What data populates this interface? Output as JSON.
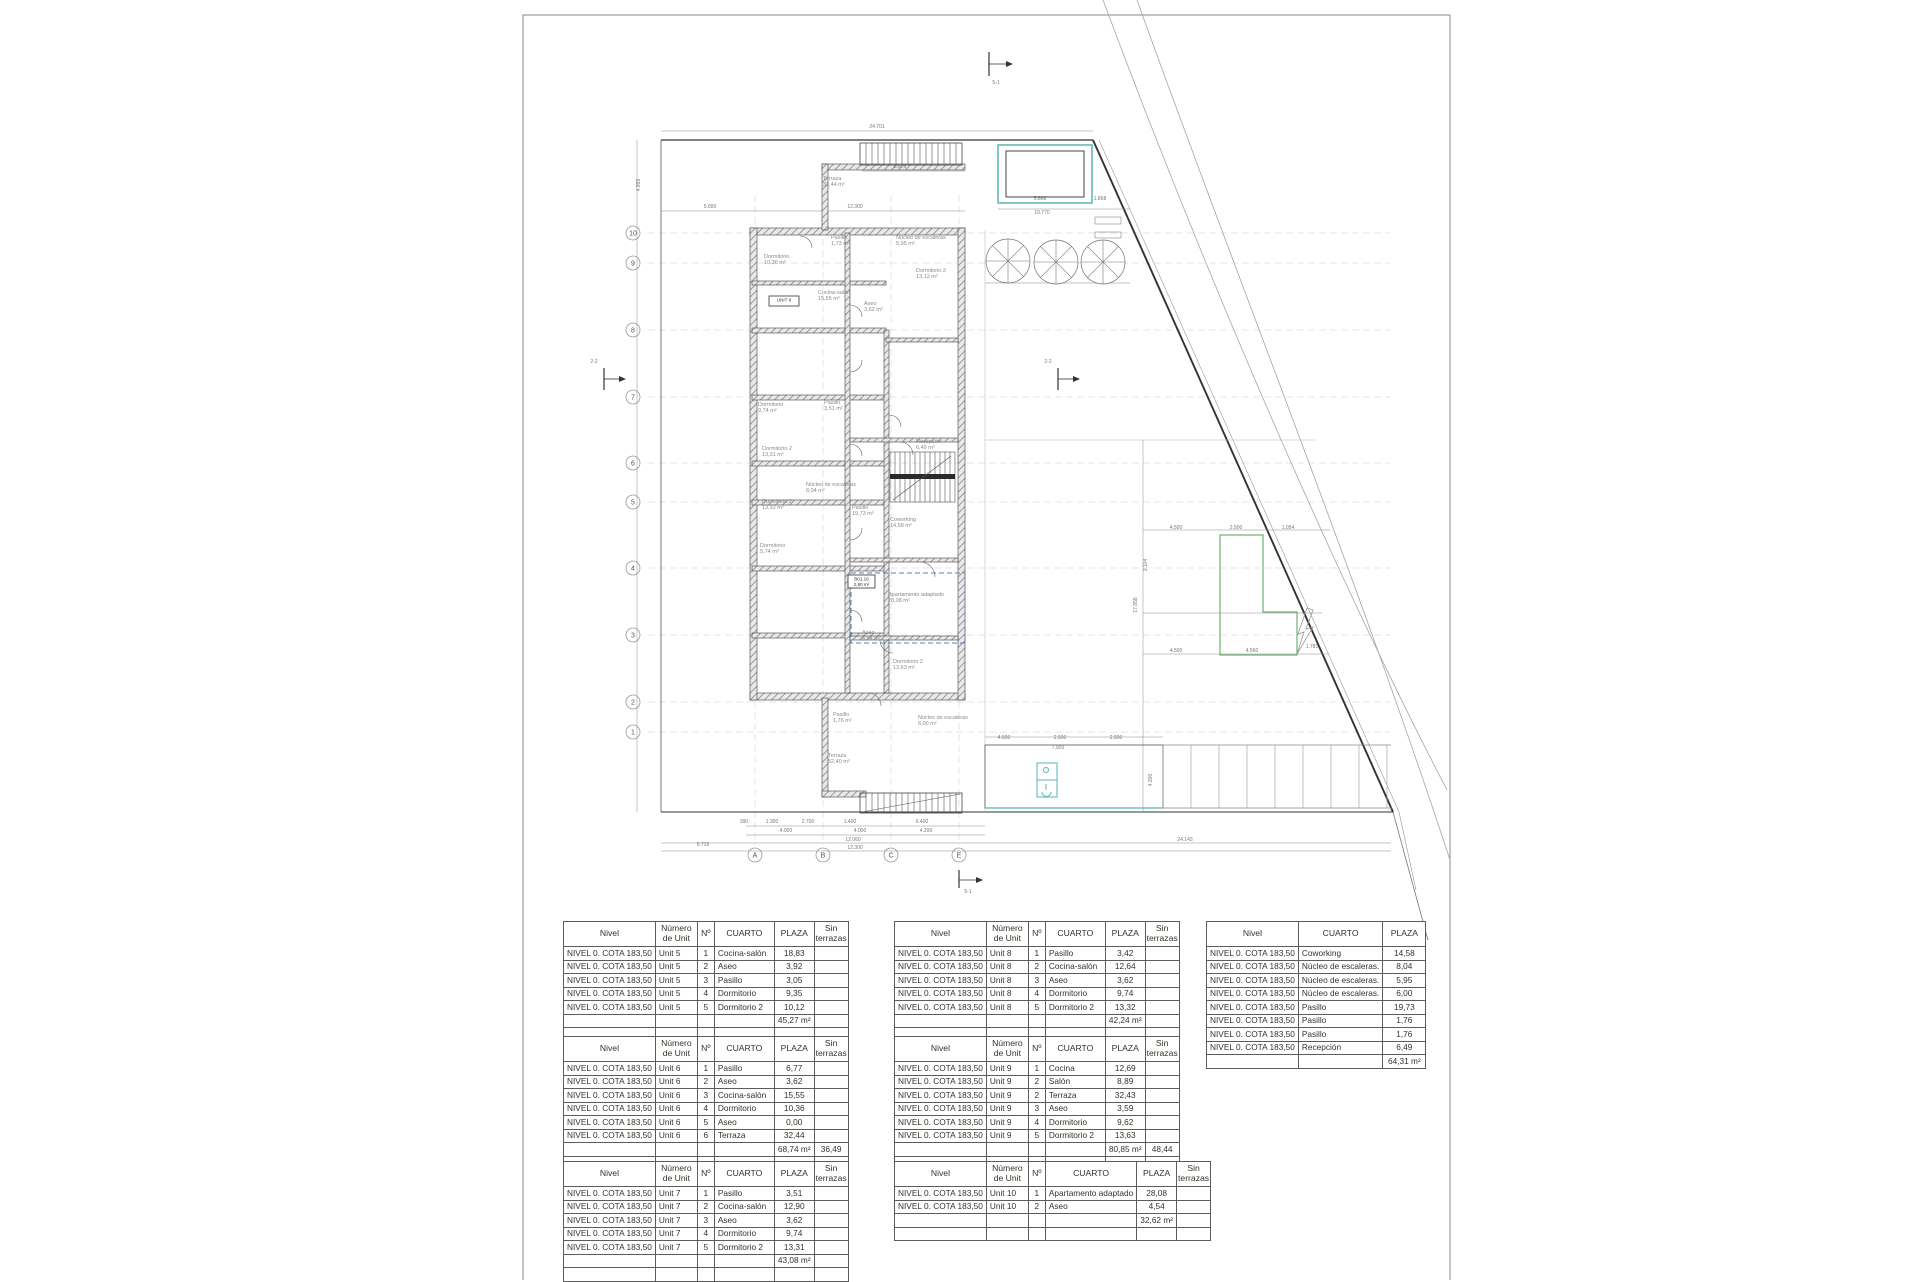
{
  "plan": {
    "colors": {
      "teal": "#5ab5b0",
      "green": "#52a352",
      "blue": "#5a7fc4",
      "line": "#3c3c3c",
      "light": "#9a9a9a"
    },
    "grid_rows": [
      {
        "label": "10",
        "y": 233
      },
      {
        "label": "9",
        "y": 263
      },
      {
        "label": "8",
        "y": 330
      },
      {
        "label": "7",
        "y": 397
      },
      {
        "label": "6",
        "y": 463
      },
      {
        "label": "5",
        "y": 502
      },
      {
        "label": "4",
        "y": 568
      },
      {
        "label": "3",
        "y": 635
      },
      {
        "label": "2",
        "y": 702
      },
      {
        "label": "1",
        "y": 732
      }
    ],
    "grid_cols": [
      {
        "label": "A",
        "x": 755
      },
      {
        "label": "B",
        "x": 823
      },
      {
        "label": "C",
        "x": 891
      },
      {
        "label": "E",
        "x": 959
      }
    ],
    "room_labels": [
      {
        "t": "Terraza|32,44 m²",
        "x": 823,
        "y": 180
      },
      {
        "t": "Pasillo|1,73 m²",
        "x": 831,
        "y": 239
      },
      {
        "t": "Núcleo de escaleras|5,95 m²",
        "x": 896,
        "y": 239
      },
      {
        "t": "Dormitorio|10,36 m²",
        "x": 764,
        "y": 258
      },
      {
        "t": "Dormitorio 2|13,12 m²",
        "x": 916,
        "y": 272
      },
      {
        "t": "Cocina-salón|15,55 m²",
        "x": 818,
        "y": 294
      },
      {
        "t": "Aseo|3,62 m²",
        "x": 864,
        "y": 305
      },
      {
        "t": "Dormitorio|9,74 m²",
        "x": 758,
        "y": 406
      },
      {
        "t": "Pasillo|3,51 m²",
        "x": 824,
        "y": 404
      },
      {
        "t": "Recepción|6,49 m²",
        "x": 916,
        "y": 443
      },
      {
        "t": "Dormitorio 2|13,31 m²",
        "x": 762,
        "y": 450
      },
      {
        "t": "Núcleo de escaleras|8,04 m²",
        "x": 806,
        "y": 486
      },
      {
        "t": "Pasillo|19,73 m²",
        "x": 852,
        "y": 509
      },
      {
        "t": "Dormitorio 2|13,32 m²",
        "x": 762,
        "y": 503
      },
      {
        "t": "Coworking|14,58 m²",
        "x": 890,
        "y": 521
      },
      {
        "t": "Dormitorio|5,74 m²",
        "x": 760,
        "y": 547
      },
      {
        "t": "Apartamento adaptado|28,08 m²",
        "x": 888,
        "y": 596
      },
      {
        "t": "Aseo|4,54 m²",
        "x": 862,
        "y": 634
      },
      {
        "t": "Dormitorio 2|13,63 m²",
        "x": 893,
        "y": 663
      },
      {
        "t": "Pasillo|1,76 m²",
        "x": 833,
        "y": 716
      },
      {
        "t": "Núcleo de escaleras|6,00 m²",
        "x": 918,
        "y": 719
      },
      {
        "t": "Terraza|52,40 m²",
        "x": 828,
        "y": 757
      }
    ],
    "boxed_labels": [
      {
        "t": "UNIT 6",
        "x": 769,
        "y": 296,
        "w": 30,
        "h": 10
      },
      {
        "t": "B01.16|2,80 m²",
        "x": 848,
        "y": 575,
        "w": 27,
        "h": 13
      }
    ],
    "dim_labels": [
      {
        "t": "24.701",
        "x": 877,
        "y": 128
      },
      {
        "t": "8.675",
        "x": 900,
        "y": 168
      },
      {
        "t": "5.000",
        "x": 710,
        "y": 208
      },
      {
        "t": "12.300",
        "x": 855,
        "y": 208
      },
      {
        "t": "5.868",
        "x": 1040,
        "y": 200
      },
      {
        "t": "1.868",
        "x": 1100,
        "y": 200
      },
      {
        "t": "10.770",
        "x": 1042,
        "y": 214
      },
      {
        "t": "390",
        "x": 744,
        "y": 823
      },
      {
        "t": "1.300",
        "x": 772,
        "y": 823
      },
      {
        "t": "2.700",
        "x": 808,
        "y": 823
      },
      {
        "t": "1.400",
        "x": 850,
        "y": 823
      },
      {
        "t": "6.400",
        "x": 922,
        "y": 823
      },
      {
        "t": "4.000",
        "x": 786,
        "y": 832
      },
      {
        "t": "4.000",
        "x": 860,
        "y": 832
      },
      {
        "t": "4.200",
        "x": 926,
        "y": 832
      },
      {
        "t": "12.060",
        "x": 853,
        "y": 841
      },
      {
        "t": "12.300",
        "x": 855,
        "y": 849
      },
      {
        "t": "5.715",
        "x": 703,
        "y": 846
      },
      {
        "t": "24.143",
        "x": 1185,
        "y": 841
      },
      {
        "t": "4.500",
        "x": 1176,
        "y": 529
      },
      {
        "t": "2.500",
        "x": 1236,
        "y": 529
      },
      {
        "t": "1.054",
        "x": 1288,
        "y": 529
      },
      {
        "t": "4.500",
        "x": 1176,
        "y": 652
      },
      {
        "t": "4.560",
        "x": 1252,
        "y": 652
      },
      {
        "t": "1.781",
        "x": 1312,
        "y": 648
      },
      {
        "t": "4.500",
        "x": 1004,
        "y": 739
      },
      {
        "t": "2.500",
        "x": 1060,
        "y": 739
      },
      {
        "t": "2.500",
        "x": 1116,
        "y": 739
      },
      {
        "t": "7.920",
        "x": 1058,
        "y": 749
      },
      {
        "t": "4.999",
        "x": 640,
        "y": 185,
        "rot": -90
      },
      {
        "t": "3.104",
        "x": 1147,
        "y": 565,
        "rot": -90
      },
      {
        "t": "17.858",
        "x": 1137,
        "y": 605,
        "rot": -90
      },
      {
        "t": "4.300",
        "x": 1152,
        "y": 780,
        "rot": -90
      },
      {
        "t": "5-1",
        "x": 996,
        "y": 84
      },
      {
        "t": "5-1",
        "x": 968,
        "y": 893
      },
      {
        "t": "2-2",
        "x": 594,
        "y": 363
      },
      {
        "t": "2-2",
        "x": 1048,
        "y": 363
      }
    ]
  },
  "tables": {
    "unit5": {
      "headers": [
        "Nivel",
        "Número de Unit",
        "Nº",
        "CUARTO",
        "PLAZA",
        "Sin terrazas"
      ],
      "rows": [
        [
          "NIVEL 0. COTA 183,50",
          "Unit 5",
          "1",
          "Cocina-salón",
          "18,83",
          ""
        ],
        [
          "NIVEL 0. COTA 183,50",
          "Unit 5",
          "2",
          "Aseo",
          "3,92",
          ""
        ],
        [
          "NIVEL 0. COTA 183,50",
          "Unit 5",
          "3",
          "Pasillo",
          "3,05",
          ""
        ],
        [
          "NIVEL 0. COTA 183,50",
          "Unit 5",
          "4",
          "Dormitorio",
          "9,35",
          ""
        ],
        [
          "NIVEL 0. COTA 183,50",
          "Unit 5",
          "5",
          "Dormitorio 2",
          "10,12",
          ""
        ],
        [
          "",
          "",
          "",
          "",
          "45,27 m²",
          ""
        ],
        [
          "",
          "",
          "",
          "",
          "",
          ""
        ]
      ]
    },
    "unit6": {
      "headers": [
        "Nivel",
        "Número de Unit",
        "Nº",
        "CUARTO",
        "PLAZA",
        "Sin terrazas"
      ],
      "rows": [
        [
          "NIVEL 0. COTA 183,50",
          "Unit 6",
          "1",
          "Pasillo",
          "6,77",
          ""
        ],
        [
          "NIVEL 0. COTA 183,50",
          "Unit 6",
          "2",
          "Aseo",
          "3,62",
          ""
        ],
        [
          "NIVEL 0. COTA 183,50",
          "Unit 6",
          "3",
          "Cocina-salón",
          "15,55",
          ""
        ],
        [
          "NIVEL 0. COTA 183,50",
          "Unit 6",
          "4",
          "Dormitorio",
          "10,36",
          ""
        ],
        [
          "NIVEL 0. COTA 183,50",
          "Unit 6",
          "5",
          "Aseo",
          "0,00",
          ""
        ],
        [
          "NIVEL 0. COTA 183,50",
          "Unit 6",
          "6",
          "Terraza",
          "32,44",
          ""
        ],
        [
          "",
          "",
          "",
          "",
          "68,74 m²",
          "36,49"
        ],
        [
          "",
          "",
          "",
          "",
          "",
          ""
        ]
      ]
    },
    "unit7": {
      "headers": [
        "Nivel",
        "Número de Unit",
        "Nº",
        "CUARTO",
        "PLAZA",
        "Sin terrazas"
      ],
      "rows": [
        [
          "NIVEL 0. COTA 183,50",
          "Unit 7",
          "1",
          "Pasillo",
          "3,51",
          ""
        ],
        [
          "NIVEL 0. COTA 183,50",
          "Unit 7",
          "2",
          "Cocina-salón",
          "12,90",
          ""
        ],
        [
          "NIVEL 0. COTA 183,50",
          "Unit 7",
          "3",
          "Aseo",
          "3,62",
          ""
        ],
        [
          "NIVEL 0. COTA 183,50",
          "Unit 7",
          "4",
          "Dormitorio",
          "9,74",
          ""
        ],
        [
          "NIVEL 0. COTA 183,50",
          "Unit 7",
          "5",
          "Dormitorio 2",
          "13,31",
          ""
        ],
        [
          "",
          "",
          "",
          "",
          "43,08 m²",
          ""
        ],
        [
          "",
          "",
          "",
          "",
          "",
          ""
        ]
      ]
    },
    "unit8": {
      "headers": [
        "Nivel",
        "Número de Unit",
        "Nº",
        "CUARTO",
        "PLAZA",
        "Sin terrazas"
      ],
      "rows": [
        [
          "NIVEL 0. COTA 183,50",
          "Unit 8",
          "1",
          "Pasillo",
          "3,42",
          ""
        ],
        [
          "NIVEL 0. COTA 183,50",
          "Unit 8",
          "2",
          "Cocina-salón",
          "12,64",
          ""
        ],
        [
          "NIVEL 0. COTA 183,50",
          "Unit 8",
          "3",
          "Aseo",
          "3,62",
          ""
        ],
        [
          "NIVEL 0. COTA 183,50",
          "Unit 8",
          "4",
          "Dormitorio",
          "9,74",
          ""
        ],
        [
          "NIVEL 0. COTA 183,50",
          "Unit 8",
          "5",
          "Dormitorio 2",
          "13,32",
          ""
        ],
        [
          "",
          "",
          "",
          "",
          "42,24 m²",
          ""
        ],
        [
          "",
          "",
          "",
          "",
          "",
          ""
        ]
      ]
    },
    "unit9": {
      "headers": [
        "Nivel",
        "Número de Unit",
        "Nº",
        "CUARTO",
        "PLAZA",
        "Sin terrazas"
      ],
      "rows": [
        [
          "NIVEL 0. COTA 183,50",
          "Unit 9",
          "1",
          "Cocina",
          "12,69",
          ""
        ],
        [
          "NIVEL 0. COTA 183,50",
          "Unit 9",
          "2",
          "Salón",
          "8,89",
          ""
        ],
        [
          "NIVEL 0. COTA 183,50",
          "Unit 9",
          "2",
          "Terraza",
          "32,43",
          ""
        ],
        [
          "NIVEL 0. COTA 183,50",
          "Unit 9",
          "3",
          "Aseo",
          "3,59",
          ""
        ],
        [
          "NIVEL 0. COTA 183,50",
          "Unit 9",
          "4",
          "Dormitorio",
          "9,62",
          ""
        ],
        [
          "NIVEL 0. COTA 183,50",
          "Unit 9",
          "5",
          "Dormitorio 2",
          "13,63",
          ""
        ],
        [
          "",
          "",
          "",
          "",
          "80,85 m²",
          "48,44"
        ],
        [
          "",
          "",
          "",
          "",
          "",
          ""
        ]
      ]
    },
    "unit10": {
      "headers": [
        "Nivel",
        "Número de Unit",
        "Nº",
        "CUARTO",
        "PLAZA",
        "Sin terrazas"
      ],
      "rows": [
        [
          "NIVEL 0. COTA 183,50",
          "Unit 10",
          "1",
          "Apartamento adaptado",
          "28,08",
          ""
        ],
        [
          "NIVEL 0. COTA 183,50",
          "Unit 10",
          "2",
          "Aseo",
          "4,54",
          ""
        ],
        [
          "",
          "",
          "",
          "",
          "32,62 m²",
          ""
        ],
        [
          "",
          "",
          "",
          "",
          "",
          ""
        ]
      ]
    },
    "common": {
      "headers": [
        "Nivel",
        "CUARTO",
        "PLAZA"
      ],
      "rows": [
        [
          "NIVEL 0. COTA 183,50",
          "Coworking",
          "14,58"
        ],
        [
          "NIVEL 0. COTA 183,50",
          "Núcleo de escaleras.",
          "8,04"
        ],
        [
          "NIVEL 0. COTA 183,50",
          "Núcleo de escaleras.",
          "5,95"
        ],
        [
          "NIVEL 0. COTA 183,50",
          "Núcleo de escaleras.",
          "6,00"
        ],
        [
          "NIVEL 0. COTA 183,50",
          "Pasillo",
          "19,73"
        ],
        [
          "NIVEL 0. COTA 183,50",
          "Pasillo",
          "1,76"
        ],
        [
          "NIVEL 0. COTA 183,50",
          "Pasillo",
          "1,76"
        ],
        [
          "NIVEL 0. COTA 183,50",
          "Recepción",
          "6,49"
        ],
        [
          "",
          "",
          "64,31 m²"
        ]
      ]
    }
  }
}
